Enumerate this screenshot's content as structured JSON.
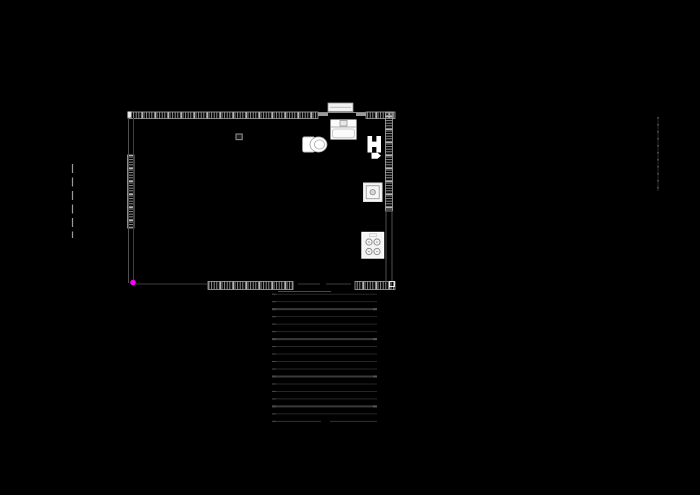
{
  "app": {
    "type": "cad-floor-plan-canvas",
    "canvas_width": 700,
    "canvas_height": 495
  },
  "colors": {
    "background": "#000000",
    "wall_hatch": "#8f8f8f",
    "wall_hatch_bright": "#c9c9c9",
    "wall_edge": "#a8a8a8",
    "stair_line": "#262626",
    "stair_line_bright": "#3a3a3a",
    "stair_head": "#474747",
    "snap_marker": "#ff00ff"
  },
  "plan": {
    "hatched_walls": [
      {
        "name": "wall-top-left",
        "x": 128,
        "y": 112,
        "w": 190,
        "h": 6.5,
        "dir": "h"
      },
      {
        "name": "wall-top-right",
        "x": 366,
        "y": 112,
        "w": 29,
        "h": 6.5,
        "dir": "h"
      },
      {
        "name": "wall-left-middle",
        "x": 127.5,
        "y": 155,
        "w": 6.5,
        "h": 73,
        "dir": "v"
      },
      {
        "name": "wall-right-upper",
        "x": 385.5,
        "y": 112,
        "w": 7,
        "h": 99,
        "dir": "v"
      },
      {
        "name": "wall-bottom-mid",
        "x": 208,
        "y": 281.5,
        "w": 85,
        "h": 8,
        "dir": "h"
      },
      {
        "name": "wall-bottom-right",
        "x": 355,
        "y": 281.5,
        "w": 40,
        "h": 8,
        "dir": "h"
      }
    ],
    "lines": [
      {
        "name": "left-wall-outer-line",
        "x1": 128.5,
        "y1": 118,
        "x2": 128.5,
        "y2": 283,
        "c": "#4f4f4f",
        "w": 1
      },
      {
        "name": "left-wall-inner-line",
        "x1": 133.5,
        "y1": 118,
        "x2": 133.5,
        "y2": 283,
        "c": "#3f3f3f",
        "w": 1
      },
      {
        "name": "right-wall-outer-line",
        "x1": 386,
        "y1": 211,
        "x2": 386,
        "y2": 282,
        "c": "#4f4f4f",
        "w": 1
      },
      {
        "name": "right-wall-inner-line",
        "x1": 392,
        "y1": 211,
        "x2": 392,
        "y2": 282,
        "c": "#4f4f4f",
        "w": 1
      },
      {
        "name": "door-opening-head-line",
        "x1": 318,
        "y1": 112.5,
        "x2": 366,
        "y2": 112.5,
        "c": "#8a8a8a",
        "w": 1
      },
      {
        "name": "door-jamb-left",
        "x1": 318,
        "y1": 114.5,
        "x2": 328,
        "y2": 114.5,
        "c": "#9a9a9a",
        "w": 3
      },
      {
        "name": "door-jamb-right",
        "x1": 356,
        "y1": 114.5,
        "x2": 366,
        "y2": 114.5,
        "c": "#9a9a9a",
        "w": 3
      },
      {
        "name": "bottom-wall-faint-line",
        "x1": 136,
        "y1": 284,
        "x2": 207,
        "y2": 284,
        "c": "#3c3c3c",
        "w": 1
      },
      {
        "name": "bottom-wall-dash-1",
        "x1": 298,
        "y1": 284,
        "x2": 320,
        "y2": 284,
        "c": "#3c3c3c",
        "w": 1
      },
      {
        "name": "bottom-wall-dash-2",
        "x1": 326,
        "y1": 284,
        "x2": 351,
        "y2": 284,
        "c": "#3c3c3c",
        "w": 1
      },
      {
        "name": "below-wall-line",
        "x1": 278,
        "y1": 291.5,
        "x2": 331,
        "y2": 291.5,
        "c": "#4a4a4a",
        "w": 1
      }
    ],
    "fixtures": [
      {
        "name": "door-leaf",
        "shapes": [
          {
            "t": "rect",
            "x": 328,
            "y": 103,
            "w": 25,
            "h": 8.5,
            "f": "#f2f2f2",
            "s": "#999999",
            "sw": 0.8
          },
          {
            "t": "line",
            "x1": 330,
            "y1": 107.2,
            "x2": 351,
            "y2": 107.2,
            "s": "#9a9a9a",
            "sw": 0.7
          }
        ]
      },
      {
        "name": "sink",
        "shapes": [
          {
            "t": "rect",
            "x": 330.5,
            "y": 119.5,
            "w": 26,
            "h": 20,
            "f": "#fbfbfb",
            "s": "#8c8c8c",
            "sw": 1,
            "rx": 1
          },
          {
            "t": "line",
            "x1": 330.5,
            "y1": 127,
            "x2": 356.5,
            "y2": 127,
            "s": "#9a9a9a",
            "sw": 0.8
          },
          {
            "t": "rect",
            "x": 340,
            "y": 120.5,
            "w": 7,
            "h": 5.5,
            "f": "#e8e8e8",
            "s": "#979797",
            "sw": 0.8
          },
          {
            "t": "rect",
            "x": 332.5,
            "y": 129,
            "w": 22,
            "h": 8.8,
            "f": "none",
            "s": "#bdbdbd",
            "sw": 0.8,
            "rx": 2.5
          }
        ]
      },
      {
        "name": "toilet",
        "shapes": [
          {
            "t": "rect",
            "x": 302.5,
            "y": 136.8,
            "w": 12.5,
            "h": 15.4,
            "f": "#ffffff",
            "s": "#9a9a9a",
            "sw": 0.8,
            "rx": 2
          },
          {
            "t": "ellipse",
            "cx": 318.5,
            "cy": 144.5,
            "rx": 8.5,
            "ry": 7.6,
            "f": "#ffffff",
            "s": "#9a9a9a",
            "sw": 0.8
          },
          {
            "t": "ellipse",
            "cx": 319.5,
            "cy": 144.5,
            "rx": 5,
            "ry": 4.6,
            "f": "none",
            "s": "#a8a8a8",
            "sw": 0.8
          }
        ]
      },
      {
        "name": "radiator-h-block",
        "shapes": [
          {
            "t": "rect",
            "x": 367.5,
            "y": 136,
            "w": 4.6,
            "h": 16.5,
            "f": "#ffffff"
          },
          {
            "t": "rect",
            "x": 376.4,
            "y": 136,
            "w": 4.6,
            "h": 16.5,
            "f": "#ffffff"
          },
          {
            "t": "rect",
            "x": 371,
            "y": 141.6,
            "w": 6.5,
            "h": 5.4,
            "f": "#ffffff"
          }
        ]
      },
      {
        "name": "flow-direction-arrow",
        "shapes": [
          {
            "t": "poly",
            "pts": "371.5,152.8 377.6,152.8 381,155.8 377.6,158.8 371.5,158.8",
            "f": "#ffffff"
          }
        ]
      },
      {
        "name": "floor-drain",
        "shapes": [
          {
            "t": "rect",
            "x": 363.5,
            "y": 183,
            "w": 18.5,
            "h": 18.5,
            "f": "#f7f7f7",
            "s": "#e0e0e0",
            "sw": 1
          },
          {
            "t": "rect",
            "x": 366.2,
            "y": 185.7,
            "w": 13,
            "h": 13,
            "f": "none",
            "s": "#9a9a9a",
            "sw": 0.9
          },
          {
            "t": "circle",
            "cx": 372.7,
            "cy": 192.2,
            "r": 2.7,
            "f": "#d6d6d6",
            "s": "#8a8a8a",
            "sw": 0.8
          }
        ]
      },
      {
        "name": "stove-four-burners",
        "shapes": [
          {
            "t": "rect",
            "x": 362,
            "y": 232.5,
            "w": 21.5,
            "h": 25.5,
            "f": "#f4f4f4",
            "s": "#ffffff",
            "sw": 1.4
          },
          {
            "t": "rect",
            "x": 369.5,
            "y": 233.8,
            "w": 7,
            "h": 2.6,
            "f": "none",
            "s": "#b0b0b0",
            "sw": 0.5
          },
          {
            "t": "circle",
            "cx": 369,
            "cy": 242,
            "r": 3.1,
            "f": "none",
            "s": "#8f8f8f",
            "sw": 1
          },
          {
            "t": "circle",
            "cx": 377,
            "cy": 242,
            "r": 3.1,
            "f": "none",
            "s": "#8f8f8f",
            "sw": 1
          },
          {
            "t": "circle",
            "cx": 369,
            "cy": 251.5,
            "r": 3.1,
            "f": "none",
            "s": "#8f8f8f",
            "sw": 1
          },
          {
            "t": "circle",
            "cx": 377,
            "cy": 251.5,
            "r": 3.1,
            "f": "none",
            "s": "#8f8f8f",
            "sw": 1
          },
          {
            "t": "circle",
            "cx": 369,
            "cy": 242,
            "r": 0.8,
            "f": "#9a9a9a"
          },
          {
            "t": "circle",
            "cx": 377,
            "cy": 242,
            "r": 0.8,
            "f": "#9a9a9a"
          },
          {
            "t": "circle",
            "cx": 369,
            "cy": 251.5,
            "r": 0.8,
            "f": "#9a9a9a"
          },
          {
            "t": "circle",
            "cx": 377,
            "cy": 251.5,
            "r": 0.8,
            "f": "#9a9a9a"
          }
        ]
      },
      {
        "name": "ceiling-light-symbol",
        "shapes": [
          {
            "t": "rect",
            "x": 236,
            "y": 134,
            "w": 6.2,
            "h": 5.6,
            "f": "#1c1c1c",
            "s": "#8a8a8a",
            "sw": 1.1
          }
        ]
      },
      {
        "name": "corner-marker-top-left",
        "shapes": [
          {
            "t": "rect",
            "x": 127.5,
            "y": 111.5,
            "w": 4,
            "h": 6,
            "f": "#e8e8e8"
          }
        ]
      },
      {
        "name": "corner-marker-bottom-right",
        "shapes": [
          {
            "t": "rect",
            "x": 389.5,
            "y": 281.5,
            "w": 5,
            "h": 5,
            "f": "none",
            "s": "#e8e8e8",
            "sw": 1
          }
        ]
      }
    ],
    "stairs": {
      "x1": 272,
      "x2": 377,
      "y_start": 294.2,
      "dy": 7.48,
      "count": 18,
      "color": "#262626",
      "width": 1,
      "thick_indexes": [
        2,
        6,
        11,
        15
      ],
      "thick_color": "#3a3a3a",
      "thick_width": 2,
      "head": {
        "width": 4,
        "color": "#474747"
      },
      "nub": {
        "color": "#555555",
        "width": 4
      },
      "last_gap": {
        "x1": 321,
        "x2": 330
      }
    },
    "guides": [
      {
        "name": "left-reference-dashed-line",
        "x": 72.5,
        "y1": 164,
        "y2": 238,
        "color": "#9a9a9a",
        "width": 1.2,
        "dash": "9 4.5"
      },
      {
        "name": "right-reference-dotted-line",
        "x": 658,
        "y1": 117,
        "y2": 191,
        "color": "#888888",
        "width": 1,
        "dash": "1.5 5.5",
        "base": "#2b2b2b"
      }
    ],
    "snap_marker": {
      "cx": 133,
      "cy": 282.5,
      "r": 2.8
    }
  }
}
